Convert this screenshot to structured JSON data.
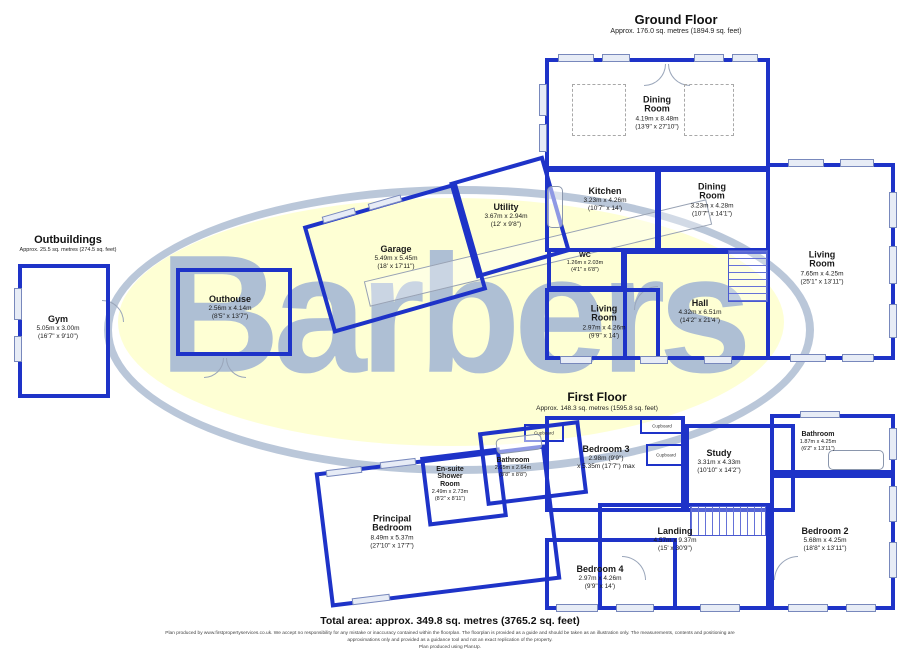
{
  "watermark": {
    "text": "Barbers",
    "text_color": "rgba(160,180,212,0.85)",
    "ellipse_fill": "#feffd4",
    "ring_color": "#bac7d9"
  },
  "colors": {
    "wall": "#1e33c8"
  },
  "headings": {
    "ground_floor": {
      "title": "Ground Floor",
      "area": "Approx. 176.0 sq. metres (1894.9 sq. feet)"
    },
    "first_floor": {
      "title": "First Floor",
      "area": "Approx. 148.3 sq. metres (1595.8 sq. feet)"
    },
    "outbuildings": {
      "title": "Outbuildings",
      "area": "Approx. 25.5 sq. metres (274.5 sq. feet)"
    }
  },
  "footer": {
    "total_area": "Total area: approx. 349.8 sq. metres (3765.2 sq. feet)",
    "disclaimer_line1": "Plan produced by www.firstpropertyservices.co.uk. We accept no responsibility for any mistake or inaccuracy contained within the floorplan. The floorplan is provided as a guide and should be taken as an illustration only. The measurements, contents and positioning are",
    "disclaimer_line2": "approximations only and provided as a guidance tool and not an exact replication of the property.",
    "disclaimer_line3": "Plan produced using PlanUp."
  },
  "cupboard_label": "Cupboard",
  "plan": {
    "rooms": [
      {
        "id": "dining-room-main",
        "floor": "ground",
        "name": [
          "Dining",
          "Room"
        ],
        "dims": [
          "4.19m x 8.48m",
          "(13'9\" x 27'10\")"
        ],
        "rect": [
          545,
          58,
          225,
          112
        ],
        "rot": 0,
        "labelAt": [
          657,
          113
        ]
      },
      {
        "id": "kitchen",
        "floor": "ground",
        "name": [
          "Kitchen"
        ],
        "dims": [
          "3.23m x 4.26m",
          "(10'7\" x 14')"
        ],
        "rect": [
          545,
          168,
          114,
          84
        ],
        "rot": 0,
        "labelAt": [
          605,
          200
        ]
      },
      {
        "id": "dining-room-2",
        "floor": "ground",
        "name": [
          "Dining",
          "Room"
        ],
        "dims": [
          "3.23m x 4.28m",
          "(10'7\" x 14'1\")"
        ],
        "rect": [
          657,
          168,
          113,
          84
        ],
        "rot": 0,
        "labelAt": [
          712,
          200
        ]
      },
      {
        "id": "wc",
        "floor": "ground",
        "name": [
          "WC"
        ],
        "dims": [
          "1.26m x 2.03m",
          "(4'1\" x 6'8\")"
        ],
        "rect": [
          547,
          248,
          78,
          42
        ],
        "rot": 0,
        "labelAt": [
          585,
          263
        ],
        "small": true
      },
      {
        "id": "living-room-gf",
        "floor": "ground",
        "name": [
          "Living",
          "Room"
        ],
        "dims": [
          "2.97m x 4.26m",
          "(9'9\" x 14')"
        ],
        "rect": [
          545,
          288,
          115,
          72
        ],
        "rot": 0,
        "labelAt": [
          604,
          322
        ]
      },
      {
        "id": "hall",
        "floor": "ground",
        "name": [
          "Hall"
        ],
        "dims": [
          "4.32m x 6.51m",
          "(14'2\" x 21'4\")"
        ],
        "rect": [
          623,
          250,
          147,
          110
        ],
        "rot": 0,
        "labelAt": [
          700,
          312
        ]
      },
      {
        "id": "living-room-right",
        "floor": "ground",
        "name": [
          "Living",
          "Room"
        ],
        "dims": [
          "7.65m x 4.25m",
          "(25'1\" x 13'11\")"
        ],
        "rect": [
          766,
          163,
          129,
          197
        ],
        "rot": 0,
        "labelAt": [
          822,
          268
        ]
      },
      {
        "id": "garage",
        "floor": "ground",
        "name": [
          "Garage"
        ],
        "dims": [
          "5.49m x 5.45m",
          "(18' x 17'11\")"
        ],
        "rect": [
          315,
          202,
          160,
          112
        ],
        "rot": -16,
        "labelAt": [
          396,
          258
        ]
      },
      {
        "id": "utility",
        "floor": "ground",
        "name": [
          "Utility"
        ],
        "dims": [
          "3.67m x 2.94m",
          "(12' x 9'8\")"
        ],
        "rect": [
          461,
          167,
          98,
          100
        ],
        "rot": -16,
        "labelAt": [
          506,
          216
        ]
      },
      {
        "id": "outhouse",
        "floor": "outbuildings",
        "name": [
          "Outhouse"
        ],
        "dims": [
          "2.56m x 4.14m",
          "(8'5\" x 13'7\")"
        ],
        "rect": [
          176,
          268,
          116,
          88
        ],
        "rot": 0,
        "labelAt": [
          230,
          308
        ]
      },
      {
        "id": "gym",
        "floor": "outbuildings",
        "name": [
          "Gym"
        ],
        "dims": [
          "5.05m x 3.00m",
          "(16'7\" x 9'10\")"
        ],
        "rect": [
          18,
          264,
          92,
          134
        ],
        "rot": 0,
        "labelAt": [
          58,
          328
        ]
      },
      {
        "id": "principal-bedroom",
        "floor": "first",
        "name": [
          "Principal",
          "Bedroom"
        ],
        "dims": [
          "8.49m x 5.37m",
          "(27'10\" x 17'7\")"
        ],
        "rect": [
          322,
          458,
          232,
          136
        ],
        "rot": -7,
        "labelAt": [
          392,
          532
        ]
      },
      {
        "id": "ensuite-shower-room",
        "floor": "first",
        "name": [
          "En-suite",
          "Shower",
          "Room"
        ],
        "dims": [
          "2.49m x 2.73m",
          "(8'2\" x 8'11\")"
        ],
        "rect": [
          424,
          452,
          80,
          70
        ],
        "rot": -7,
        "labelAt": [
          450,
          484
        ],
        "small": true
      },
      {
        "id": "bathroom-mid",
        "floor": "first",
        "name": [
          "Bathroom"
        ],
        "dims": [
          "2.65m x 2.64m",
          "(8'8\" x 8'8\")"
        ],
        "rect": [
          482,
          426,
          102,
          74
        ],
        "rot": -7,
        "labelAt": [
          513,
          468
        ],
        "small": true
      },
      {
        "id": "bedroom-3",
        "floor": "first",
        "name": [
          "Bedroom 3"
        ],
        "dims": [
          "2.98m (9'9\")",
          "x 5.35m (17'7\") max"
        ],
        "rect": [
          545,
          416,
          140,
          96
        ],
        "rot": 0,
        "labelAt": [
          606,
          458
        ]
      },
      {
        "id": "study",
        "floor": "first",
        "name": [
          "Study"
        ],
        "dims": [
          "3.31m x 4.33m",
          "(10'10\" x 14'2\")"
        ],
        "rect": [
          685,
          424,
          110,
          88
        ],
        "rot": 0,
        "labelAt": [
          719,
          462
        ]
      },
      {
        "id": "bathroom-ff",
        "floor": "first",
        "name": [
          "Bathroom"
        ],
        "dims": [
          "1.87m x 4.25m",
          "(6'2\" x 13'11\")"
        ],
        "rect": [
          770,
          414,
          125,
          60
        ],
        "rot": 0,
        "labelAt": [
          818,
          442
        ],
        "small": true
      },
      {
        "id": "bedroom-2",
        "floor": "first",
        "name": [
          "Bedroom 2"
        ],
        "dims": [
          "5.68m x 4.25m",
          "(18'8\" x 13'11\")"
        ],
        "rect": [
          770,
          474,
          125,
          136
        ],
        "rot": 0,
        "labelAt": [
          825,
          540
        ]
      },
      {
        "id": "landing",
        "floor": "first",
        "name": [
          "Landing"
        ],
        "dims": [
          "4.57m x 9.37m",
          "(15' x 30'9\")"
        ],
        "rect": [
          598,
          503,
          172,
          107
        ],
        "rot": 0,
        "labelAt": [
          675,
          540
        ]
      },
      {
        "id": "bedroom-4",
        "floor": "first",
        "name": [
          "Bedroom 4"
        ],
        "dims": [
          "2.97m x 4.26m",
          "(9'9\" x 14')"
        ],
        "rect": [
          545,
          538,
          132,
          72
        ],
        "rot": 0,
        "labelAt": [
          600,
          578
        ]
      }
    ],
    "cupboards": [
      {
        "rect": [
          524,
          424,
          40,
          18
        ]
      },
      {
        "rect": [
          640,
          418,
          44,
          16
        ]
      },
      {
        "rect": [
          646,
          444,
          40,
          22
        ]
      }
    ],
    "windows": [
      [
        558,
        54,
        36,
        8
      ],
      [
        602,
        54,
        28,
        8
      ],
      [
        694,
        54,
        30,
        8
      ],
      [
        732,
        54,
        26,
        8
      ],
      [
        788,
        159,
        36,
        8
      ],
      [
        840,
        159,
        34,
        8
      ],
      [
        889,
        192,
        8,
        36
      ],
      [
        889,
        246,
        8,
        38
      ],
      [
        889,
        304,
        8,
        34
      ],
      [
        790,
        354,
        36,
        8
      ],
      [
        842,
        354,
        32,
        8
      ],
      [
        539,
        84,
        8,
        32
      ],
      [
        539,
        124,
        8,
        28
      ],
      [
        560,
        356,
        32,
        8
      ],
      [
        640,
        356,
        28,
        8
      ],
      [
        704,
        356,
        28,
        8
      ],
      [
        14,
        288,
        8,
        32
      ],
      [
        14,
        336,
        8,
        26
      ],
      [
        556,
        604,
        42,
        8
      ],
      [
        616,
        604,
        38,
        8
      ],
      [
        700,
        604,
        40,
        8
      ],
      [
        788,
        604,
        40,
        8
      ],
      [
        846,
        604,
        30,
        8
      ],
      [
        889,
        428,
        8,
        32
      ],
      [
        889,
        486,
        8,
        36
      ],
      [
        889,
        542,
        8,
        36
      ],
      [
        322,
        212,
        34,
        7,
        -16
      ],
      [
        368,
        199,
        34,
        7,
        -16
      ],
      [
        326,
        468,
        36,
        7,
        -7
      ],
      [
        380,
        460,
        36,
        7,
        -7
      ],
      [
        352,
        596,
        38,
        7,
        -7
      ],
      [
        800,
        411,
        40,
        7
      ]
    ],
    "doors": [
      {
        "x": 644,
        "y": 64,
        "s": 22,
        "c": "br"
      },
      {
        "x": 668,
        "y": 64,
        "s": 22,
        "c": "bl"
      },
      {
        "x": 204,
        "y": 358,
        "s": 20,
        "c": "br"
      },
      {
        "x": 226,
        "y": 358,
        "s": 20,
        "c": "bl"
      },
      {
        "x": 102,
        "y": 300,
        "s": 22,
        "c": "tr"
      },
      {
        "x": 634,
        "y": 286,
        "s": 24,
        "c": "tl"
      },
      {
        "x": 622,
        "y": 556,
        "s": 24,
        "c": "tr"
      },
      {
        "x": 774,
        "y": 556,
        "s": 24,
        "c": "tl"
      }
    ],
    "stairs": [
      {
        "rect": [
          728,
          250,
          40,
          52
        ],
        "dir": "h"
      },
      {
        "rect": [
          690,
          506,
          76,
          30
        ],
        "dir": "v"
      }
    ],
    "dashed_boxes": [
      [
        572,
        84,
        54,
        52
      ],
      [
        684,
        84,
        50,
        52
      ]
    ],
    "path_strips": [
      {
        "rect": [
          362,
          240,
          352,
          26
        ],
        "rot": -13.5
      }
    ],
    "fixtures": [
      {
        "rect": [
          828,
          450,
          56,
          20
        ],
        "rot": 0
      },
      {
        "rect": [
          496,
          436,
          46,
          16
        ],
        "rot": -7
      },
      {
        "rect": [
          547,
          186,
          16,
          42
        ],
        "rot": 0
      }
    ]
  }
}
